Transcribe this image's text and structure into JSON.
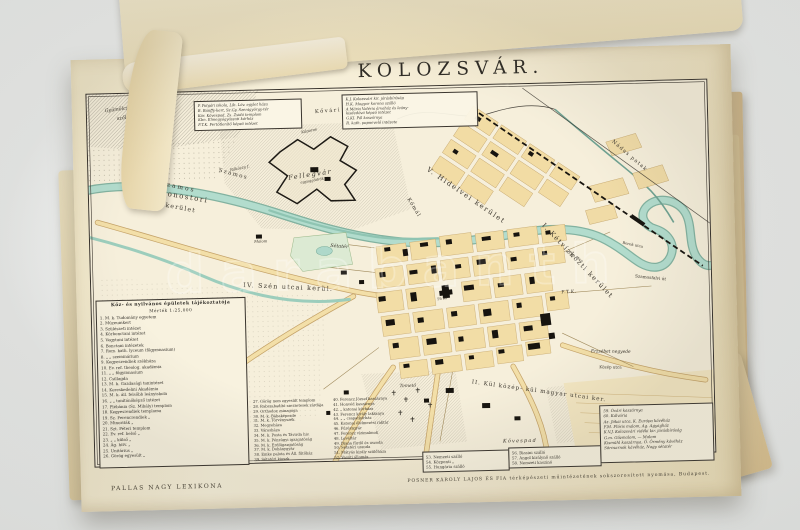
{
  "page": {
    "title": "KOLOZSVÁR.",
    "imprint_left": "PALLAS NAGY LEXIKONA",
    "imprint_right": "POSNER KÁROLY LAJOS ÉS FIA térképészeti műintézetének sokszorosított nyomása, Budapest."
  },
  "watermark": {
    "text": "darabanth"
  },
  "palette": {
    "page_cream": "#f4ebd2",
    "map_ground": "#f6efdb",
    "river_teal": "#b2dccd",
    "river_edge": "#76ab99",
    "block_yellow": "#f2dda6",
    "building_black": "#17140f",
    "ink": "#33302a",
    "stack_tan": "#e3d1a5"
  },
  "legend": {
    "header": "Köz- és nyilvános épületek tájékoztatója",
    "scale": "Mérték 1:25,000",
    "col1": [
      "1. M. k. Tudomány egyetem",
      "2. Múzeumkert",
      "3. Szülészeti intézet",
      "4. Kórbonctani intézet",
      "5. Vegytani intézet",
      "6. Bonctani intézetek",
      "7. Rom. kath. lyceum (főgymnasium)",
      "8.   „    „   szeminárium",
      "9. Kegyesrendiek székháza",
      "10. Ev. ref. theolog. akadémia",
      "11.  „   „   főgymnasium",
      "12. Csillagda",
      "13. M. k. Gazdasági tanintézet",
      "14. Kereskedelmi Akadémia",
      "15. M. k. áll. felsőbb leányiskola",
      "16.  „   „  tanítónőképző intézet",
      "17. Plébánia (Sz. Mihály) templom",
      "18. Kegyesrendiek temploma",
      "19. Sz. Ferencrendiek    „",
      "20. Minoriták    „",
      "21. Szt. Péteri templom",
      "22. Ev. ref. belső    „",
      "23.  „   „  külső    „",
      "24. Ág. hitv.    „",
      "25. Unitárius    „",
      "26. Görög egyesült    „"
    ],
    "col2": [
      "27. Görög nem egyesült templom",
      "28. Rabszabadító szerzetesek zárdája",
      "29. Orthodox zsinagóga",
      "30. M. k. Bábaképezde",
      "31. M. k. Törvényszék",
      "32. Megyeháza",
      "33. Városháza",
      "34. M. k. Posta és Távirda hiv.",
      "35. M. k. Pénzügyi igazgatóság",
      "36. M. k. Erdőigazgatóság",
      "37. M. k. Dohánygyár",
      "38. Emke palota és Áll. fűtőház",
      "39. Sétatéri kioszk"
    ],
    "col3": [
      "40. Ferencz József kaszárnya",
      "41. Honvéd kaszárnya",
      "42.  „  katonai kórháza",
      "43. Ferencz király laktanya",
      "44.  „   „  csapatkórház",
      "45. Katonai élelmezési raktár",
      "46. Fűrészgyár",
      "47. Ferencz vízimalmok",
      "48. Levéltár",
      "49. Diana fürdő és uszoda",
      "50. Sétatéri uszoda",
      "51. Mátyás király szülőháza",
      "52. Vasúti állomás"
    ],
    "hotels_a": [
      "53. Nemzeti szálló",
      "54. Központi    „",
      "55. Hungária szálló"
    ],
    "hotels_b": [
      "56. Biasini szálló",
      "57. Angol királynő szálló",
      "58. Nemzeti kaszinó"
    ],
    "abbrev_left": [
      "P. Polgári iskola, Lib. Löv. egylet háza",
      "B. Bánffy-kert, Sz.Gy. Szentgyörgy-tér",
      "Kör. Kövespad, Zs. Zsidó templom",
      "Kbn. Elmegyógyászati kórház",
      "F.T.K. Fertőtlenítő képző intézet"
    ],
    "abbrev_right": [
      "K.J. Kolozsvári kir. járásbíróság",
      "H.K. Magyar korona szálló",
      "A Mária Valéria árvaház és leány-",
      "kisdedóvó képző intézet",
      "G.KI. Pál kaszárnya",
      "R. kath. papnevelő intézete"
    ],
    "notes_right": [
      "59. Óvári kaszárnya",
      "60. Kálvária",
      "Az. Jókai utca, K. Európa kávéház",
      "F.M. Flóris malom, Ag. Agyagház",
      "K.V.J. Kolozsvári vidéki kir. járásbíróság",
      "G.m. Gőzmalom, — Malom",
      "Kismühl kaszárnya, Ő. Örmény kávéház",
      "Sörcsarnok kávéház, Nagy sétatér"
    ]
  },
  "map": {
    "labels": {
      "gyumolcsos": "Gyümölcsös",
      "szolo": "szőlő",
      "hoja": "Hója hegy",
      "rakoczy": "Rákóczy f.",
      "koporos": "Kőporos",
      "agyaggodrok": "agyaggödrök",
      "szamos_a": "Szamos",
      "szamos_b": "Szamos",
      "kis_szamos": "K. Szamos",
      "malom": "Malom",
      "nadas": "Nádas patak",
      "kovari": "Kővári telep",
      "fellegvar": "Fellegvár",
      "komal": "Kőmál",
      "hidelve": "V. Hidelvei kerület",
      "monostori1": "VI. Monostori",
      "monostori2": "kerület",
      "szen": "IV. Szén utcai kerül.",
      "ketviz": "I. Kétvízközti kerület",
      "kulmagyar": "II. Kül közép- kül magyar utcai ker.",
      "setater": "Sétatér",
      "foter": "Fő tér",
      "temeto": "Temető",
      "kovespad": "Kövespad",
      "erzsebet": "Erzsébet negyede",
      "kozep": "Közép utca",
      "szamosfalvi": "Szamosfalvi út",
      "pap": "Pap utca",
      "berek": "Berek utca",
      "ftk": "F.T.K."
    }
  }
}
